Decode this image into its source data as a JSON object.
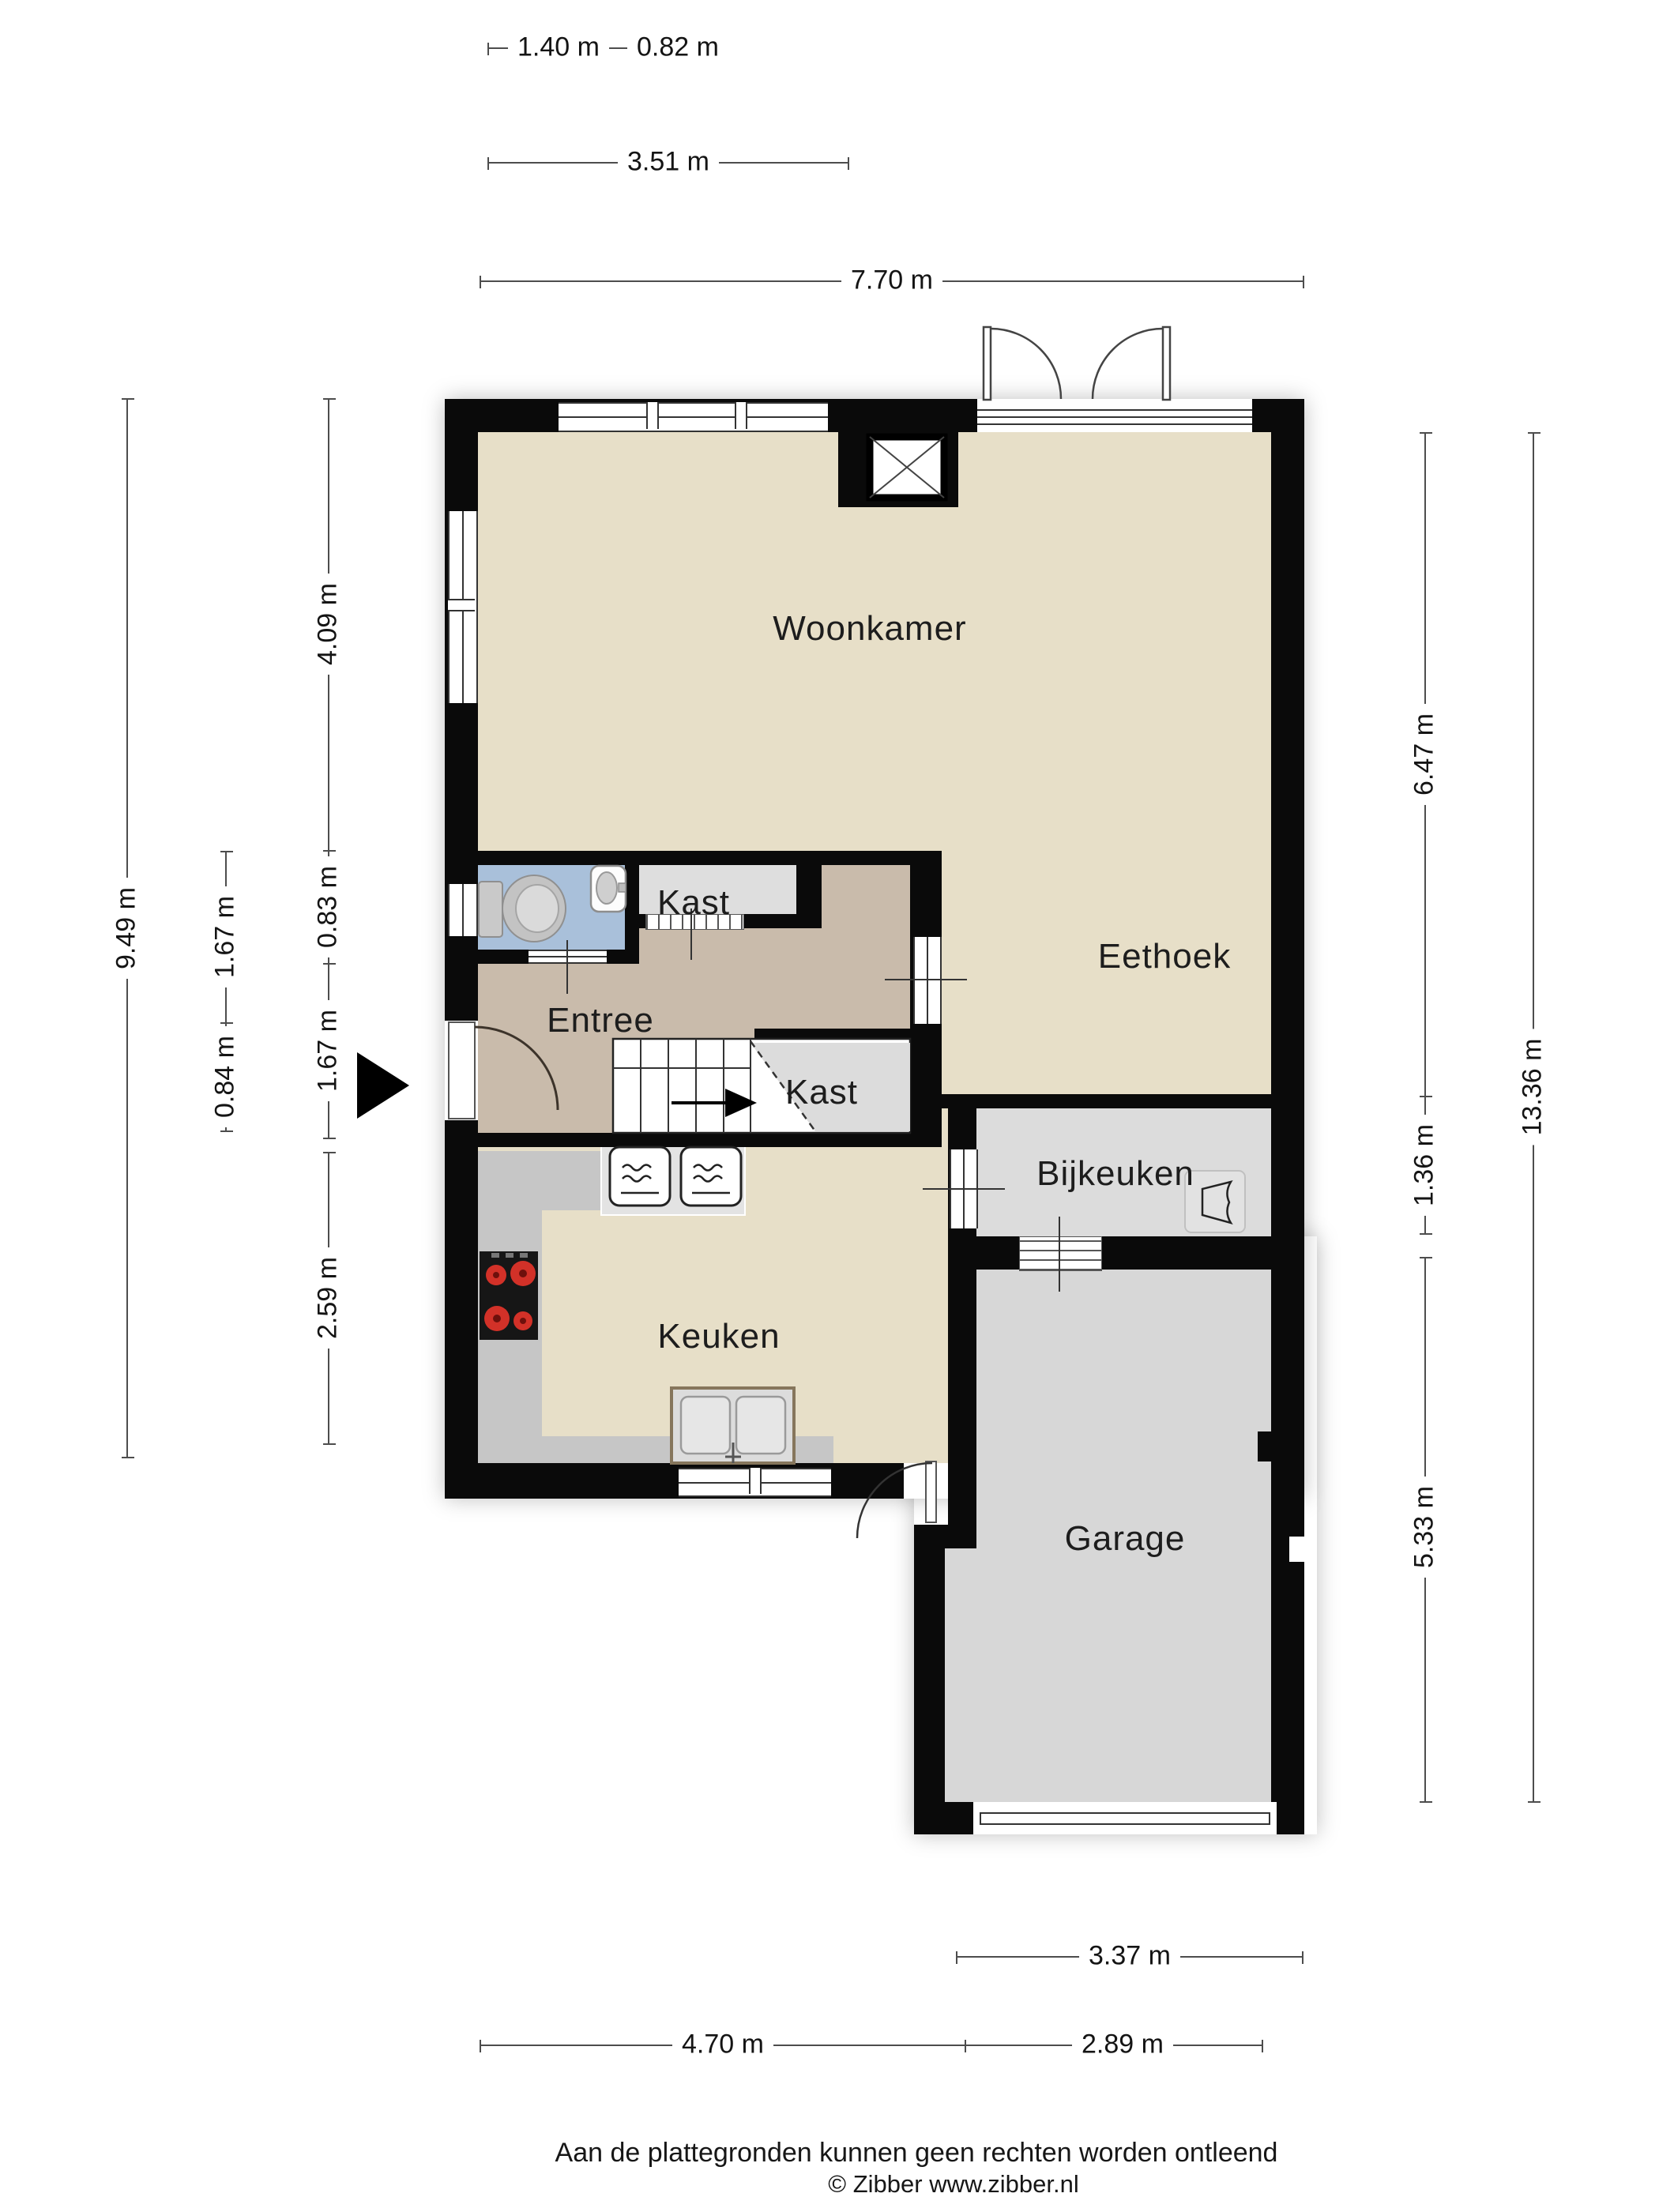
{
  "plan_title": "Begane grond plattegrond (Zibber stijl)",
  "rooms": [
    {
      "id": "woonkamer",
      "label": "Woonkamer"
    },
    {
      "id": "eethoek",
      "label": "Eethoek"
    },
    {
      "id": "entree",
      "label": "Entree"
    },
    {
      "id": "kast_boven",
      "label": "Kast"
    },
    {
      "id": "kast_trap",
      "label": "Kast"
    },
    {
      "id": "keuken",
      "label": "Keuken"
    },
    {
      "id": "bijkeuken",
      "label": "Bijkeuken"
    },
    {
      "id": "garage",
      "label": "Garage"
    }
  ],
  "dimensions": {
    "top": [
      {
        "label": "1.40 m"
      },
      {
        "label": "0.82 m"
      },
      {
        "label": "3.51 m"
      },
      {
        "label": "7.70 m"
      }
    ],
    "left": [
      {
        "label": "9.49 m"
      },
      {
        "label": "1.67 m"
      },
      {
        "label": "0.84 m"
      },
      {
        "label": "4.09 m"
      },
      {
        "label": "0.83 m"
      },
      {
        "label": "1.67 m"
      },
      {
        "label": "2.59 m"
      }
    ],
    "right": [
      {
        "label": "6.47 m"
      },
      {
        "label": "1.36 m"
      },
      {
        "label": "5.33 m"
      },
      {
        "label": "13.36 m"
      }
    ],
    "bottom": [
      {
        "label": "3.37 m"
      },
      {
        "label": "4.70 m"
      },
      {
        "label": "2.89 m"
      }
    ]
  },
  "icons": [
    "toilet-icon",
    "washbasin-icon",
    "stove-icon",
    "oven-icon",
    "kitchen-sink-icon",
    "boiler-icon",
    "stairs-icon",
    "entrance-arrow-icon",
    "chimney-icon",
    "door-swing-icon"
  ],
  "colors": {
    "wall": "#0a0a0a",
    "living_floor": "#e7dfc8",
    "entree_floor": "#c9bbab",
    "toilet_floor": "#a9c0da",
    "closet_floor": "#dedede",
    "bijkeuken_floor": "#dcdcdc",
    "garage_floor": "#d7d7d7",
    "counter": "#c6c6c6",
    "burner": "#d23128"
  },
  "footer": {
    "line1": "Aan de plattegronden kunnen geen rechten worden ontleend",
    "line2": "© Zibber www.zibber.nl"
  }
}
